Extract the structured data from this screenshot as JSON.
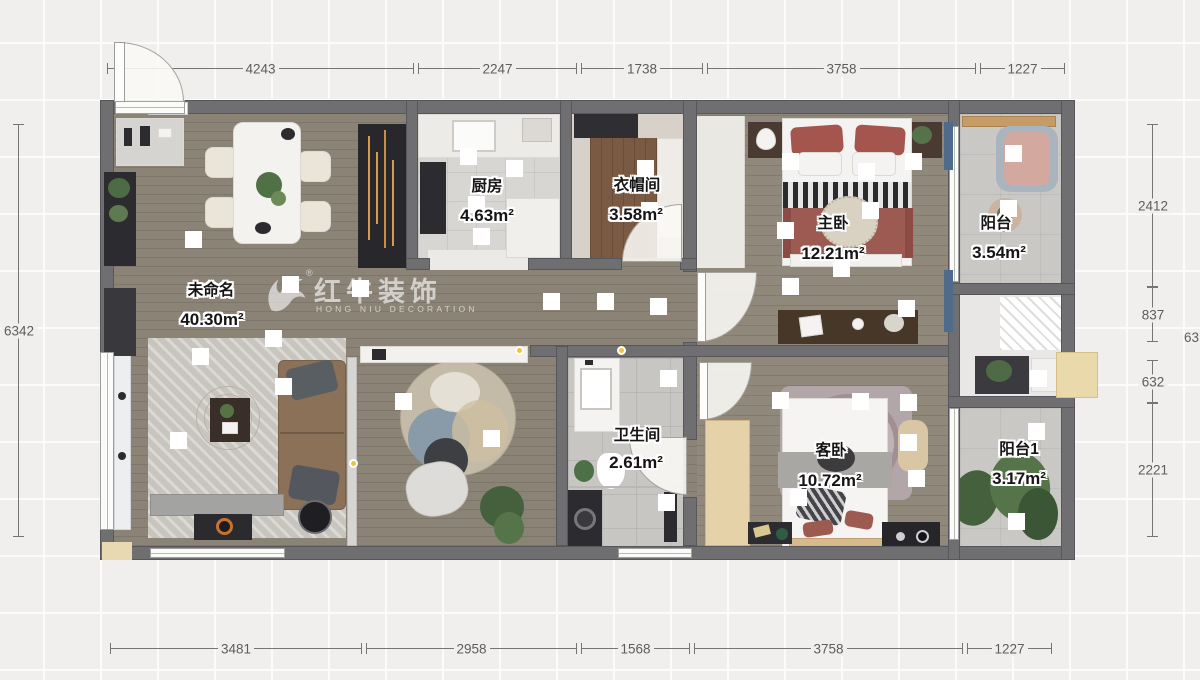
{
  "watermark": {
    "brand": "红牛装饰",
    "subtitle": "HONG NIU DECORATION",
    "registered": "®"
  },
  "rooms": [
    {
      "name": "厨房",
      "area": "4.63m²"
    },
    {
      "name": "衣帽间",
      "area": "3.58m²"
    },
    {
      "name": "主卧",
      "area": "12.21m²"
    },
    {
      "name": "阳台",
      "area": "3.54m²"
    },
    {
      "name": "未命名",
      "area": "40.30m²"
    },
    {
      "name": "卫生间",
      "area": "2.61m²"
    },
    {
      "name": "客卧",
      "area": "10.72m²"
    },
    {
      "name": "阳台1",
      "area": "3.17m²"
    }
  ],
  "dimensions": {
    "top": [
      "4243",
      "2247",
      "1738",
      "3758",
      "1227"
    ],
    "bottom": [
      "3481",
      "2958",
      "1568",
      "3758",
      "1227"
    ],
    "left": [
      "6342"
    ],
    "right": [
      "2412",
      "837",
      "632",
      "2221"
    ],
    "right_edge_partial": "63"
  },
  "colors": {
    "wall": "#6f6f72",
    "wood_floor": "#8b8376",
    "accent_orange": "#d79a4a",
    "marker_yellow": "#f2c23b",
    "dimension_text": "#5d5d5d"
  }
}
